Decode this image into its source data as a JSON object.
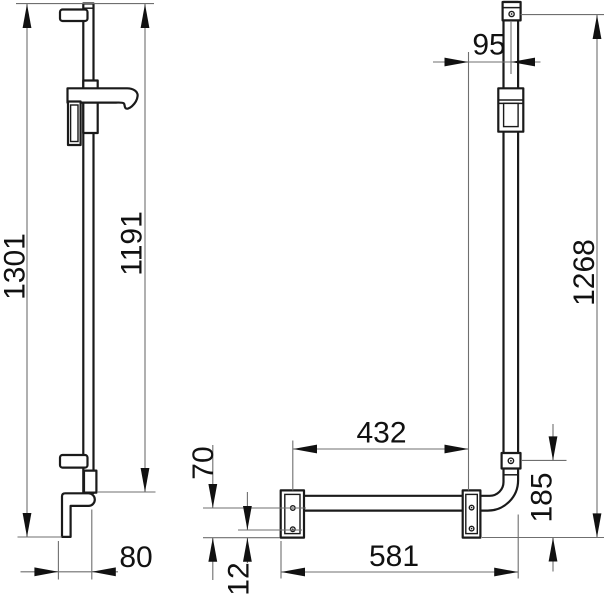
{
  "page": {
    "background": "#ffffff"
  },
  "drawing": {
    "type": "technical-dimension-drawing",
    "colors": {
      "outline": "#1a1a1a",
      "dimension_line": "#6f6f6f",
      "text": "#111111",
      "fill": "#ffffff"
    },
    "dimensions": {
      "rail_total_height": "1301",
      "rail_upper_section": "1191",
      "rail_bottom_offset": "80",
      "bar_top_offset": "95",
      "plate_hole_spacing": "432",
      "plate_drop_below_bar": "70",
      "hole_to_plate_edge": "12",
      "bar_overall_length": "581",
      "vertical_bar_height": "1268",
      "corner_to_plate_bottom": "185"
    }
  }
}
